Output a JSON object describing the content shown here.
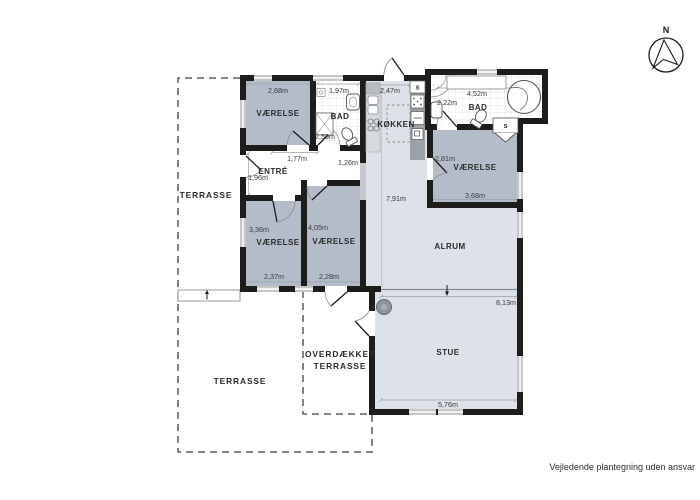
{
  "footer": {
    "disclaimer": "Vejledende plantegning uden ansvar"
  },
  "compass": {
    "north_label": "N"
  },
  "colors": {
    "wall": "#1d1d1b",
    "room_dark": "#b4bcc9",
    "room_light": "#dce2e8",
    "window": "#c7c7c7",
    "tile_line": "#dde0e3",
    "dash": "#3f3f3f"
  },
  "rooms": {
    "vaerelse_tl": {
      "label": "VÆRELSE",
      "width": "2,68m"
    },
    "bad_tl": {
      "label": "BAD",
      "width": "1,97m",
      "depth": "2,59m"
    },
    "koekken": {
      "label": "KØKKEN",
      "width": "2,47m"
    },
    "bad_tr": {
      "label": "BAD",
      "width": "4,52m",
      "width2": "2,22m"
    },
    "vaerelse_tr": {
      "label": "VÆRELSE",
      "depth": "2,81m",
      "width": "3,68m"
    },
    "entre": {
      "label": "ENTRÉ",
      "width": "1,77m",
      "depth": "1,96m",
      "hall": "1,26m"
    },
    "vaerelse_ml": {
      "label": "VÆRELSE",
      "depth": "3,36m",
      "width": "2,37m"
    },
    "vaerelse_mr": {
      "label": "VÆRELSE",
      "depth": "4,05m",
      "width": "2,28m"
    },
    "alrum": {
      "label": "ALRUM",
      "depth": "7,91m"
    },
    "stue": {
      "label": "STUE",
      "width_top": "8,13m",
      "width_bottom": "5,76m"
    },
    "terrasse_left": {
      "label": "TERRASSE"
    },
    "terrasse_bottom": {
      "label": "TERRASSE"
    },
    "overdaekket": {
      "label_line1": "OVERDÆKKET",
      "label_line2": "TERRASSE"
    },
    "closet": {
      "label": "S"
    }
  }
}
